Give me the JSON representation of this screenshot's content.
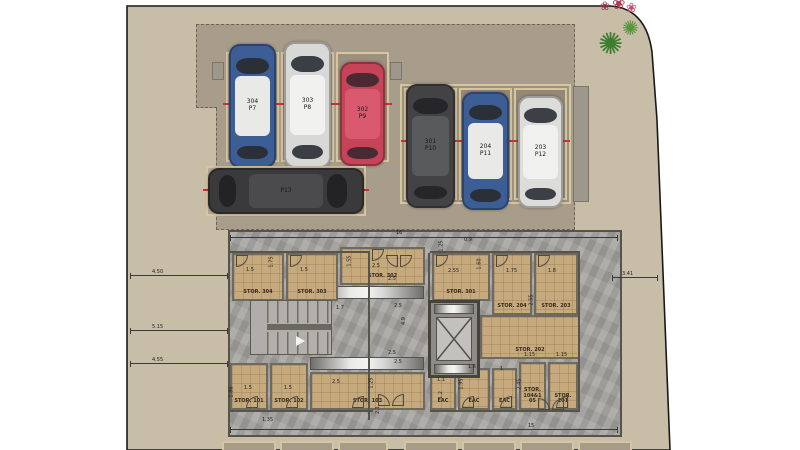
{
  "scene": "residential-basement-parking-floor-plan",
  "palette": {
    "lot_beige": "#c8bea8",
    "driveway": "#a89d8a",
    "stall_border": "#d6c69e",
    "plan_gray": "#a19f9b",
    "room_tan": "#c6aa7e",
    "wall_dark": "#56534b",
    "tick_red": "#c23437",
    "plant_green": "#3f7d2e",
    "flower_red": "#b03a52"
  },
  "parking": {
    "stalls": [
      {
        "unit": "304",
        "stall": "P7",
        "hcls": "",
        "s": {
          "left": "226px",
          "top": "52px",
          "width": "53px",
          "height": "110px"
        },
        "cs": {
          "left": "229px",
          "top": "44px",
          "width": "47px",
          "height": "124px",
          "--body": "#3d5e95",
          "--roof": "#e9e9e7",
          "--glass": "#2b2f38"
        }
      },
      {
        "unit": "303",
        "stall": "P8",
        "hcls": "",
        "s": {
          "left": "281px",
          "top": "52px",
          "width": "53px",
          "height": "110px"
        },
        "cs": {
          "left": "284px",
          "top": "42px",
          "width": "47px",
          "height": "126px",
          "--body": "#d8d8d6",
          "--roof": "#f1f1ef",
          "--glass": "#3b3e44"
        }
      },
      {
        "unit": "302",
        "stall": "P9",
        "hcls": "",
        "s": {
          "left": "336px",
          "top": "52px",
          "width": "53px",
          "height": "110px"
        },
        "cs": {
          "left": "340px",
          "top": "62px",
          "width": "45px",
          "height": "104px",
          "--body": "#c64458",
          "--roof": "#d95a6e",
          "--glass": "#4a2a32"
        }
      },
      {
        "unit": "",
        "stall": "P13",
        "hcls": "h",
        "s": {
          "left": "206px",
          "top": "166px",
          "width": "160px",
          "height": "50px"
        },
        "cs": {
          "left": "208px",
          "top": "168px",
          "width": "156px",
          "height": "46px",
          "--body": "#3a393b",
          "--roof": "#4b4a4d",
          "--glass": "#232325"
        }
      },
      {
        "unit": "301",
        "stall": "P10",
        "hcls": "",
        "s": {
          "left": "404px",
          "top": "88px",
          "width": "53px",
          "height": "112px"
        },
        "cs": {
          "left": "406px",
          "top": "84px",
          "width": "49px",
          "height": "124px",
          "--body": "#434245",
          "--roof": "#585a5c",
          "--glass": "#26262a"
        }
      },
      {
        "unit": "204",
        "stall": "P11",
        "hcls": "",
        "s": {
          "left": "459px",
          "top": "88px",
          "width": "53px",
          "height": "112px"
        },
        "cs": {
          "left": "462px",
          "top": "92px",
          "width": "47px",
          "height": "118px",
          "--body": "#3d5e95",
          "--roof": "#e9e9e7",
          "--glass": "#2b2f38"
        }
      },
      {
        "unit": "203",
        "stall": "P12",
        "hcls": "",
        "s": {
          "left": "514px",
          "top": "88px",
          "width": "53px",
          "height": "112px"
        },
        "cs": {
          "left": "518px",
          "top": "96px",
          "width": "45px",
          "height": "112px",
          "--body": "#dcdcda",
          "--roof": "#f0f0ee",
          "--glass": "#3c3f45"
        }
      }
    ]
  },
  "rooms": [
    {
      "label": "STOR. 304",
      "s": {
        "left": "232px",
        "top": "253px",
        "width": "52px",
        "height": "48px"
      }
    },
    {
      "label": "STOR. 303",
      "s": {
        "left": "286px",
        "top": "253px",
        "width": "52px",
        "height": "48px"
      }
    },
    {
      "label": "STOR. 302",
      "s": {
        "left": "340px",
        "top": "247px",
        "width": "85px",
        "height": "38px"
      }
    },
    {
      "label": "STOR. 301",
      "s": {
        "left": "432px",
        "top": "253px",
        "width": "58px",
        "height": "48px"
      }
    },
    {
      "label": "STOR. 204",
      "s": {
        "left": "492px",
        "top": "253px",
        "width": "40px",
        "height": "62px"
      }
    },
    {
      "label": "STOR. 203",
      "s": {
        "left": "534px",
        "top": "253px",
        "width": "44px",
        "height": "62px"
      }
    },
    {
      "label": "STOR. 202",
      "s": {
        "left": "480px",
        "top": "315px",
        "width": "100px",
        "height": "44px"
      }
    },
    {
      "label": "STOR. 101",
      "s": {
        "left": "230px",
        "top": "363px",
        "width": "38px",
        "height": "47px"
      }
    },
    {
      "label": "STOR. 102",
      "s": {
        "left": "270px",
        "top": "363px",
        "width": "38px",
        "height": "47px"
      }
    },
    {
      "label": "STOR. 103",
      "s": {
        "left": "310px",
        "top": "372px",
        "width": "115px",
        "height": "38px"
      }
    },
    {
      "label": "EAC",
      "s": {
        "left": "430px",
        "top": "372px",
        "width": "26px",
        "height": "38px"
      }
    },
    {
      "label": "EAC",
      "s": {
        "left": "458px",
        "top": "368px",
        "width": "32px",
        "height": "42px"
      }
    },
    {
      "label": "EAC",
      "s": {
        "left": "492px",
        "top": "368px",
        "width": "25px",
        "height": "42px"
      }
    },
    {
      "label": "STOR. 104&105",
      "s": {
        "left": "519px",
        "top": "362px",
        "width": "27px",
        "height": "48px"
      }
    },
    {
      "label": "STOR. 201",
      "s": {
        "left": "548px",
        "top": "362px",
        "width": "30px",
        "height": "48px"
      }
    }
  ],
  "metal_strips": [
    {
      "s": {
        "left": "310px",
        "top": "286px",
        "width": "114px",
        "height": "13px"
      }
    },
    {
      "s": {
        "left": "310px",
        "top": "357px",
        "width": "114px",
        "height": "13px"
      }
    }
  ],
  "gray_stubs": [
    {
      "s": {
        "left": "212px",
        "top": "62px",
        "width": "12px",
        "height": "18px"
      }
    },
    {
      "s": {
        "left": "390px",
        "top": "62px",
        "width": "12px",
        "height": "18px"
      }
    },
    {
      "s": {
        "left": "573px",
        "top": "86px",
        "width": "16px",
        "height": "116px"
      }
    }
  ],
  "walls": [
    {
      "s": {
        "left": "368px",
        "top": "253px",
        "width": "2px",
        "height": "167px"
      }
    },
    {
      "s": {
        "left": "428px",
        "top": "253px",
        "width": "2px",
        "height": "49px"
      }
    },
    {
      "s": {
        "left": "228px",
        "top": "251px",
        "width": "142px",
        "height": "2px"
      }
    },
    {
      "s": {
        "left": "430px",
        "top": "251px",
        "width": "150px",
        "height": "2px"
      }
    },
    {
      "s": {
        "left": "228px",
        "top": "410px",
        "width": "145px",
        "height": "2px"
      }
    },
    {
      "s": {
        "left": "430px",
        "top": "410px",
        "width": "150px",
        "height": "2px"
      }
    },
    {
      "s": {
        "left": "578px",
        "top": "253px",
        "width": "2px",
        "height": "157px"
      }
    }
  ],
  "dim_lines": [
    {
      "s": {
        "left": "130px",
        "top": "275px",
        "width": "98px"
      }
    },
    {
      "s": {
        "left": "130px",
        "top": "330px",
        "width": "98px"
      }
    },
    {
      "s": {
        "left": "130px",
        "top": "363px",
        "width": "98px"
      }
    },
    {
      "s": {
        "left": "612px",
        "top": "277px",
        "width": "46px"
      }
    },
    {
      "s": {
        "left": "230px",
        "top": "429px",
        "width": "388px"
      }
    },
    {
      "s": {
        "left": "230px",
        "top": "237px",
        "width": "388px"
      }
    }
  ],
  "dims": [
    {
      "t": "4.50",
      "s": {
        "left": "152px",
        "top": "269px"
      }
    },
    {
      "t": "5.15",
      "s": {
        "left": "152px",
        "top": "324px"
      }
    },
    {
      "t": "4.55",
      "s": {
        "left": "152px",
        "top": "357px"
      }
    },
    {
      "t": "3.41",
      "s": {
        "left": "622px",
        "top": "271px"
      }
    },
    {
      "t": "15",
      "s": {
        "left": "528px",
        "top": "423px"
      }
    },
    {
      "t": "16",
      "s": {
        "left": "396px",
        "top": "230px"
      }
    },
    {
      "t": "1.75",
      "s": {
        "left": "266px",
        "top": "259px",
        "transform": "rotate(-90deg)"
      }
    },
    {
      "t": "1.5",
      "s": {
        "left": "246px",
        "top": "267px"
      }
    },
    {
      "t": "1.5",
      "s": {
        "left": "300px",
        "top": "267px"
      }
    },
    {
      "t": "1.55",
      "s": {
        "left": "344px",
        "top": "258px",
        "transform": "rotate(-90deg)"
      }
    },
    {
      "t": "2.5",
      "s": {
        "left": "372px",
        "top": "263px"
      }
    },
    {
      "t": "2.5",
      "s": {
        "left": "388px",
        "top": "276px"
      }
    },
    {
      "t": "4.9",
      "s": {
        "left": "400px",
        "top": "318px",
        "transform": "rotate(-90deg)"
      }
    },
    {
      "t": "2.5",
      "s": {
        "left": "388px",
        "top": "350px"
      }
    },
    {
      "t": "1.25",
      "s": {
        "left": "366px",
        "top": "380px",
        "transform": "rotate(-90deg)"
      }
    },
    {
      "t": "1.25",
      "s": {
        "left": "436px",
        "top": "243px",
        "transform": "rotate(-90deg)"
      }
    },
    {
      "t": "0.9",
      "s": {
        "left": "464px",
        "top": "237px"
      }
    },
    {
      "t": "2.55",
      "s": {
        "left": "448px",
        "top": "268px"
      }
    },
    {
      "t": "1.60",
      "s": {
        "left": "474px",
        "top": "261px",
        "transform": "rotate(-90deg)"
      }
    },
    {
      "t": "1.75",
      "s": {
        "left": "506px",
        "top": "268px"
      }
    },
    {
      "t": "1.8",
      "s": {
        "left": "548px",
        "top": "268px"
      }
    },
    {
      "t": "2.55",
      "s": {
        "left": "526px",
        "top": "297px",
        "transform": "rotate(-90deg)"
      }
    },
    {
      "t": "1.7",
      "s": {
        "left": "336px",
        "top": "305px"
      }
    },
    {
      "t": "2.5",
      "s": {
        "left": "394px",
        "top": "303px"
      }
    },
    {
      "t": "2.5",
      "s": {
        "left": "394px",
        "top": "359px"
      }
    },
    {
      "t": "2.1",
      "s": {
        "left": "374px",
        "top": "407px",
        "transform": "rotate(-90deg)"
      }
    },
    {
      "t": "1.5",
      "s": {
        "left": "244px",
        "top": "385px"
      }
    },
    {
      "t": "1.5",
      "s": {
        "left": "284px",
        "top": "385px"
      }
    },
    {
      "t": "1.86",
      "s": {
        "left": "226px",
        "top": "389px",
        "transform": "rotate(-90deg)"
      }
    },
    {
      "t": "2.5",
      "s": {
        "left": "332px",
        "top": "379px"
      }
    },
    {
      "t": "1.35",
      "s": {
        "left": "262px",
        "top": "417px"
      }
    },
    {
      "t": "1.6",
      "s": {
        "left": "468px",
        "top": "364px"
      }
    },
    {
      "t": "1",
      "s": {
        "left": "500px",
        "top": "366px"
      }
    },
    {
      "t": "1.15",
      "s": {
        "left": "524px",
        "top": "352px"
      }
    },
    {
      "t": "1.15",
      "s": {
        "left": "556px",
        "top": "352px"
      }
    },
    {
      "t": "1.95",
      "s": {
        "left": "456px",
        "top": "381px",
        "transform": "rotate(-90deg)"
      }
    },
    {
      "t": "2.45",
      "s": {
        "left": "514px",
        "top": "381px",
        "transform": "rotate(-90deg)"
      }
    },
    {
      "t": "1.1",
      "s": {
        "left": "437px",
        "top": "377px"
      }
    },
    {
      "t": "1.2",
      "s": {
        "left": "437px",
        "top": "392px",
        "transform": "rotate(-90deg)"
      }
    }
  ],
  "doors": [
    {
      "s": {
        "left": "236px",
        "top": "255px",
        "borderRadius": "0 0 100% 0"
      }
    },
    {
      "s": {
        "left": "290px",
        "top": "255px",
        "borderRadius": "0 0 100% 0"
      }
    },
    {
      "s": {
        "left": "372px",
        "top": "249px",
        "borderRadius": "0 0 100% 0"
      }
    },
    {
      "s": {
        "left": "436px",
        "top": "255px",
        "borderRadius": "0 0 100% 0"
      }
    },
    {
      "s": {
        "left": "496px",
        "top": "255px",
        "borderRadius": "0 0 100% 0"
      }
    },
    {
      "s": {
        "left": "538px",
        "top": "255px",
        "borderRadius": "0 0 100% 0"
      }
    },
    {
      "s": {
        "left": "386px",
        "top": "255px",
        "borderRadius": "0 0 0 100%"
      }
    },
    {
      "s": {
        "left": "400px",
        "top": "255px",
        "borderRadius": "0 0 100% 0"
      }
    },
    {
      "s": {
        "left": "246px",
        "top": "396px",
        "borderRadius": "100% 0 0 0"
      }
    },
    {
      "s": {
        "left": "286px",
        "top": "396px",
        "borderRadius": "100% 0 0 0"
      }
    },
    {
      "s": {
        "left": "352px",
        "top": "396px",
        "borderRadius": "100% 0 0 0"
      }
    },
    {
      "s": {
        "left": "462px",
        "top": "396px",
        "borderRadius": "100% 0 0 0"
      }
    },
    {
      "s": {
        "left": "500px",
        "top": "396px",
        "borderRadius": "100% 0 0 0"
      }
    },
    {
      "s": {
        "left": "556px",
        "top": "396px",
        "borderRadius": "100% 0 0 0"
      }
    },
    {
      "s": {
        "left": "378px",
        "top": "394px",
        "borderRadius": "0 100% 0 0"
      }
    },
    {
      "s": {
        "left": "392px",
        "top": "394px",
        "borderRadius": "100% 0 0 0"
      }
    },
    {
      "s": {
        "left": "538px",
        "top": "398px",
        "borderRadius": "0 100% 0 0"
      }
    },
    {
      "s": {
        "left": "552px",
        "top": "398px",
        "borderRadius": "100% 0 0 0"
      }
    }
  ],
  "bottom_stalls": [
    {
      "s": {
        "left": "222px",
        "top": "441px",
        "width": "54px"
      }
    },
    {
      "s": {
        "left": "280px",
        "top": "441px",
        "width": "54px"
      }
    },
    {
      "s": {
        "left": "338px",
        "top": "441px",
        "width": "50px"
      }
    },
    {
      "s": {
        "left": "404px",
        "top": "441px",
        "width": "54px"
      }
    },
    {
      "s": {
        "left": "462px",
        "top": "441px",
        "width": "54px"
      }
    },
    {
      "s": {
        "left": "520px",
        "top": "441px",
        "width": "54px"
      }
    },
    {
      "s": {
        "left": "578px",
        "top": "441px",
        "width": "54px"
      }
    }
  ],
  "plant": {
    "bush_glyph": "✺",
    "flower_glyph": "❀"
  }
}
